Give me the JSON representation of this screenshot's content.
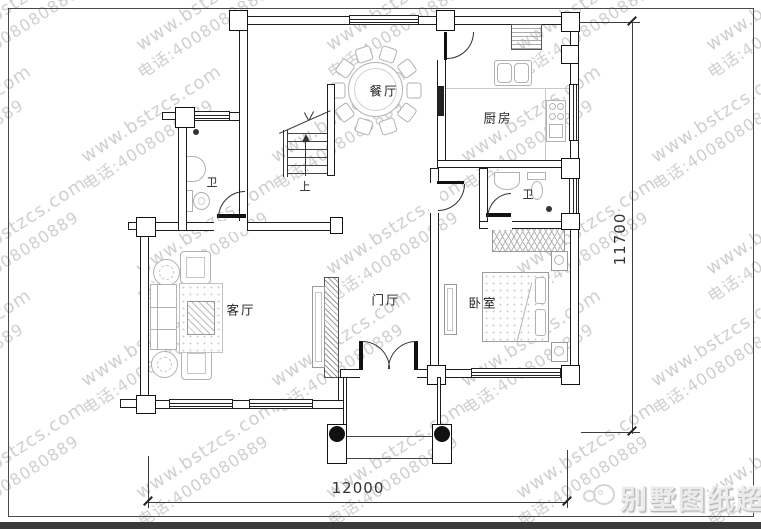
{
  "plan": {
    "rooms": [
      {
        "id": "dining-room",
        "label": "餐厅"
      },
      {
        "id": "kitchen",
        "label": "厨房"
      },
      {
        "id": "bathroom-upper",
        "label": "卫"
      },
      {
        "id": "bathroom-lower",
        "label": "卫"
      },
      {
        "id": "living-room",
        "label": "客厅"
      },
      {
        "id": "foyer",
        "label": "门厅"
      },
      {
        "id": "bedroom",
        "label": "卧室"
      }
    ],
    "stairs": {
      "direction_label": "上"
    },
    "dimensions": {
      "width": "12000",
      "height": "11700"
    }
  },
  "watermark": {
    "site": "www.bstzcs.com",
    "phone": "电话:4008080889"
  },
  "branding": {
    "name": "别墅图纸超市"
  },
  "colors": {
    "wall": "#1c1c1c",
    "fixture": "#b2b2b2",
    "watermark": "#c7c7c7",
    "dimension": "#3c3c3c",
    "footer_bar": "#3a3a3a"
  }
}
